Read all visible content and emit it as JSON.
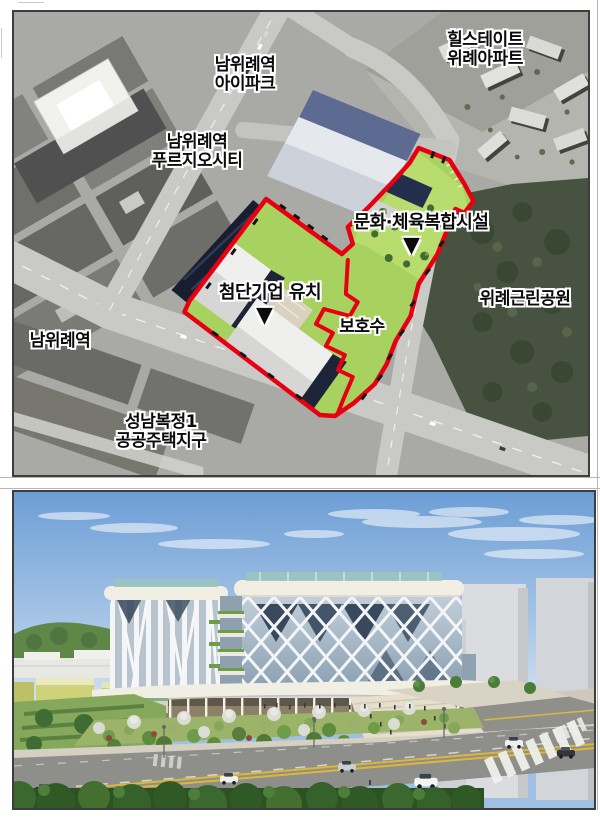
{
  "document": {
    "background": "#ffffff",
    "figures": [
      {
        "id": "aerial-map",
        "type": "satellite map with development site overlay"
      },
      {
        "id": "building-render",
        "type": "3D architectural rendering"
      }
    ]
  },
  "map": {
    "marker_glyph": "▼",
    "palette": {
      "outline_red": "#e60012",
      "site_lawn": "#a8d260",
      "park_green": "#475340",
      "frame_border": "#3d3d3b"
    },
    "labels": {
      "namwirye_ipark": {
        "line1": "남위례역",
        "line2": "아이파크"
      },
      "hillstate_wirye": {
        "line1": "힐스테이트",
        "line2": "위례아파트"
      },
      "namwirye_prugio": {
        "line1": "남위례역",
        "line2": "푸르지오시티"
      },
      "culture_sports_complex": {
        "text": "문화·체육복합시설"
      },
      "hightech_companies": {
        "text": "첨단기업 유치"
      },
      "protected_tree": {
        "text": "보호수"
      },
      "wirye_park": {
        "text": "위례근린공원"
      },
      "namwirye_station": {
        "text": "남위례역"
      },
      "seongnam_bokjeong": {
        "line1": "성남복정1",
        "line2": "공공주택지구"
      }
    }
  },
  "render": {
    "palette": {
      "sky_top": "#6d9ed6",
      "sky_horizon": "#d8e4f2",
      "facade_glass": "#b9c7d3",
      "cornice_white": "#f1eee4",
      "roof_railing_teal": "#9cc4c0"
    }
  }
}
